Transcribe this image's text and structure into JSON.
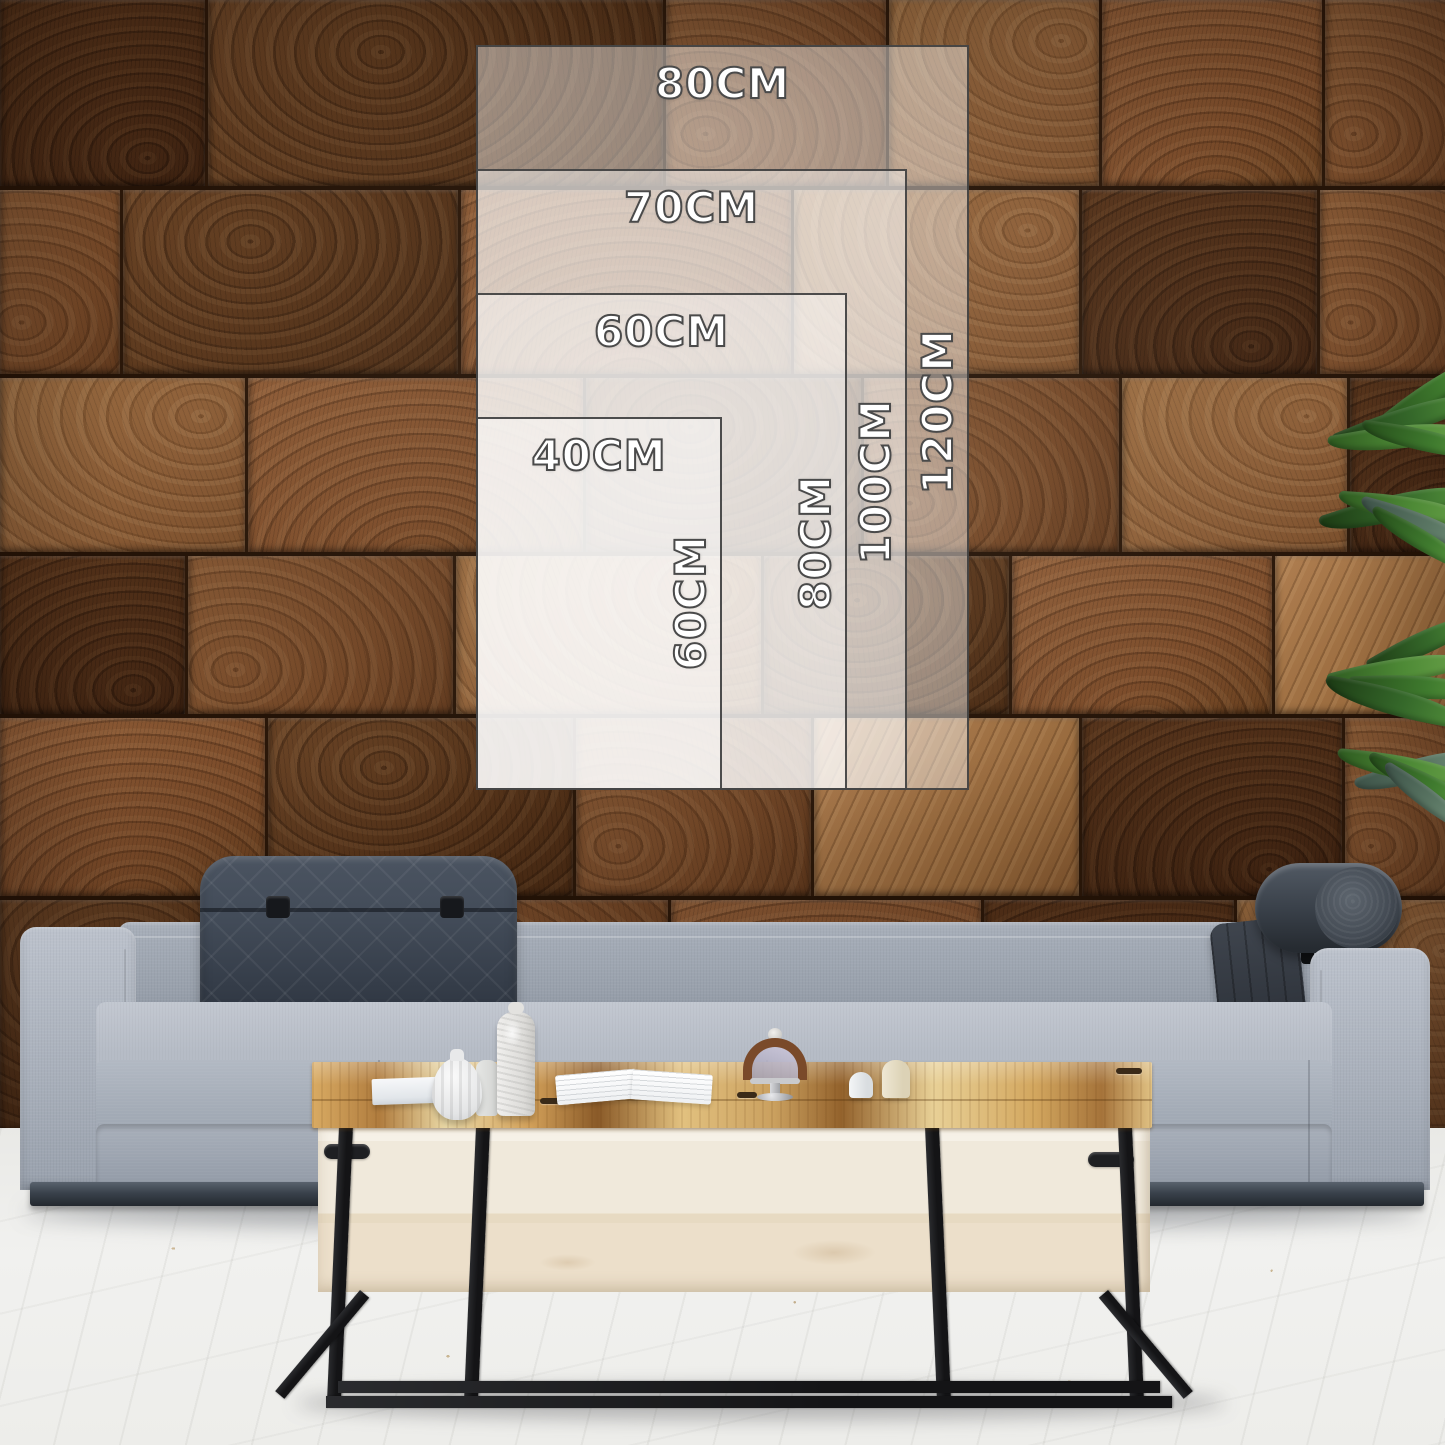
{
  "size_guide": {
    "unit": "CM",
    "labels": {
      "r1_width": "80CM",
      "r1_height": "120CM",
      "r2_width": "70CM",
      "r2_height": "100CM",
      "r3_width": "60CM",
      "r3_height": "80CM",
      "r4_width": "40CM",
      "r4_height": "60CM"
    },
    "sizes": [
      {
        "width_cm": 80,
        "height_cm": 120
      },
      {
        "width_cm": 70,
        "height_cm": 100
      },
      {
        "width_cm": 60,
        "height_cm": 80
      },
      {
        "width_cm": 40,
        "height_cm": 60
      }
    ],
    "overlay_fill": "#ffffff",
    "overlay_opacity_per_layer": 0.43,
    "border_color": "#3e3e3e",
    "text_color": "#ffffff",
    "text_outline_color": "#4a4a4a"
  },
  "scene": {
    "wall": {
      "kind": "end-grain-wood-block-wall",
      "palette": [
        "#4a2b14",
        "#462814",
        "#724626",
        "#8a5c36",
        "#7b4b29",
        "#97693c"
      ],
      "seam_color": "#241307",
      "rows": [
        {
          "top": 0,
          "height": 190,
          "blocks": [
            [
              205,
              2
            ],
            [
              455,
              1
            ],
            [
              220,
              3
            ],
            [
              210,
              4
            ],
            [
              220,
              5
            ],
            [
              160,
              3
            ]
          ]
        },
        {
          "top": 190,
          "height": 188,
          "blocks": [
            [
              120,
              3
            ],
            [
              335,
              1
            ],
            [
              330,
              5
            ],
            [
              285,
              4
            ],
            [
              235,
              2
            ],
            [
              170,
              3
            ]
          ]
        },
        {
          "top": 378,
          "height": 178,
          "blocks": [
            [
              245,
              4
            ],
            [
              335,
              5
            ],
            [
              275,
              1
            ],
            [
              255,
              3
            ],
            [
              225,
              4
            ],
            [
              140,
              2
            ]
          ]
        },
        {
          "top": 556,
          "height": 162,
          "blocks": [
            [
              185,
              2
            ],
            [
              265,
              3
            ],
            [
              305,
              4
            ],
            [
              245,
              1
            ],
            [
              260,
              5
            ],
            [
              210,
              6
            ]
          ]
        },
        {
          "top": 718,
          "height": 182,
          "blocks": [
            [
              265,
              5
            ],
            [
              305,
              1
            ],
            [
              235,
              3
            ],
            [
              265,
              6
            ],
            [
              260,
              2
            ],
            [
              145,
              3
            ]
          ]
        },
        {
          "top": 900,
          "height": 235,
          "blocks": [
            [
              310,
              1
            ],
            [
              355,
              3
            ],
            [
              310,
              5
            ],
            [
              250,
              2
            ],
            [
              250,
              4
            ]
          ]
        }
      ]
    },
    "floor": {
      "color": "#efefec"
    },
    "sofa": {
      "fabric_color": "#aab1bc",
      "headrest_cushion_color": "#3d4651",
      "bolster_color": "#3a414a",
      "base_color": "#3a424c"
    },
    "table": {
      "top_wood_color": "#d2a45f",
      "face_color": "#f0e9db",
      "leg_color": "#17181a"
    },
    "plant": {
      "leaf_color": "#3f7a2e"
    }
  }
}
